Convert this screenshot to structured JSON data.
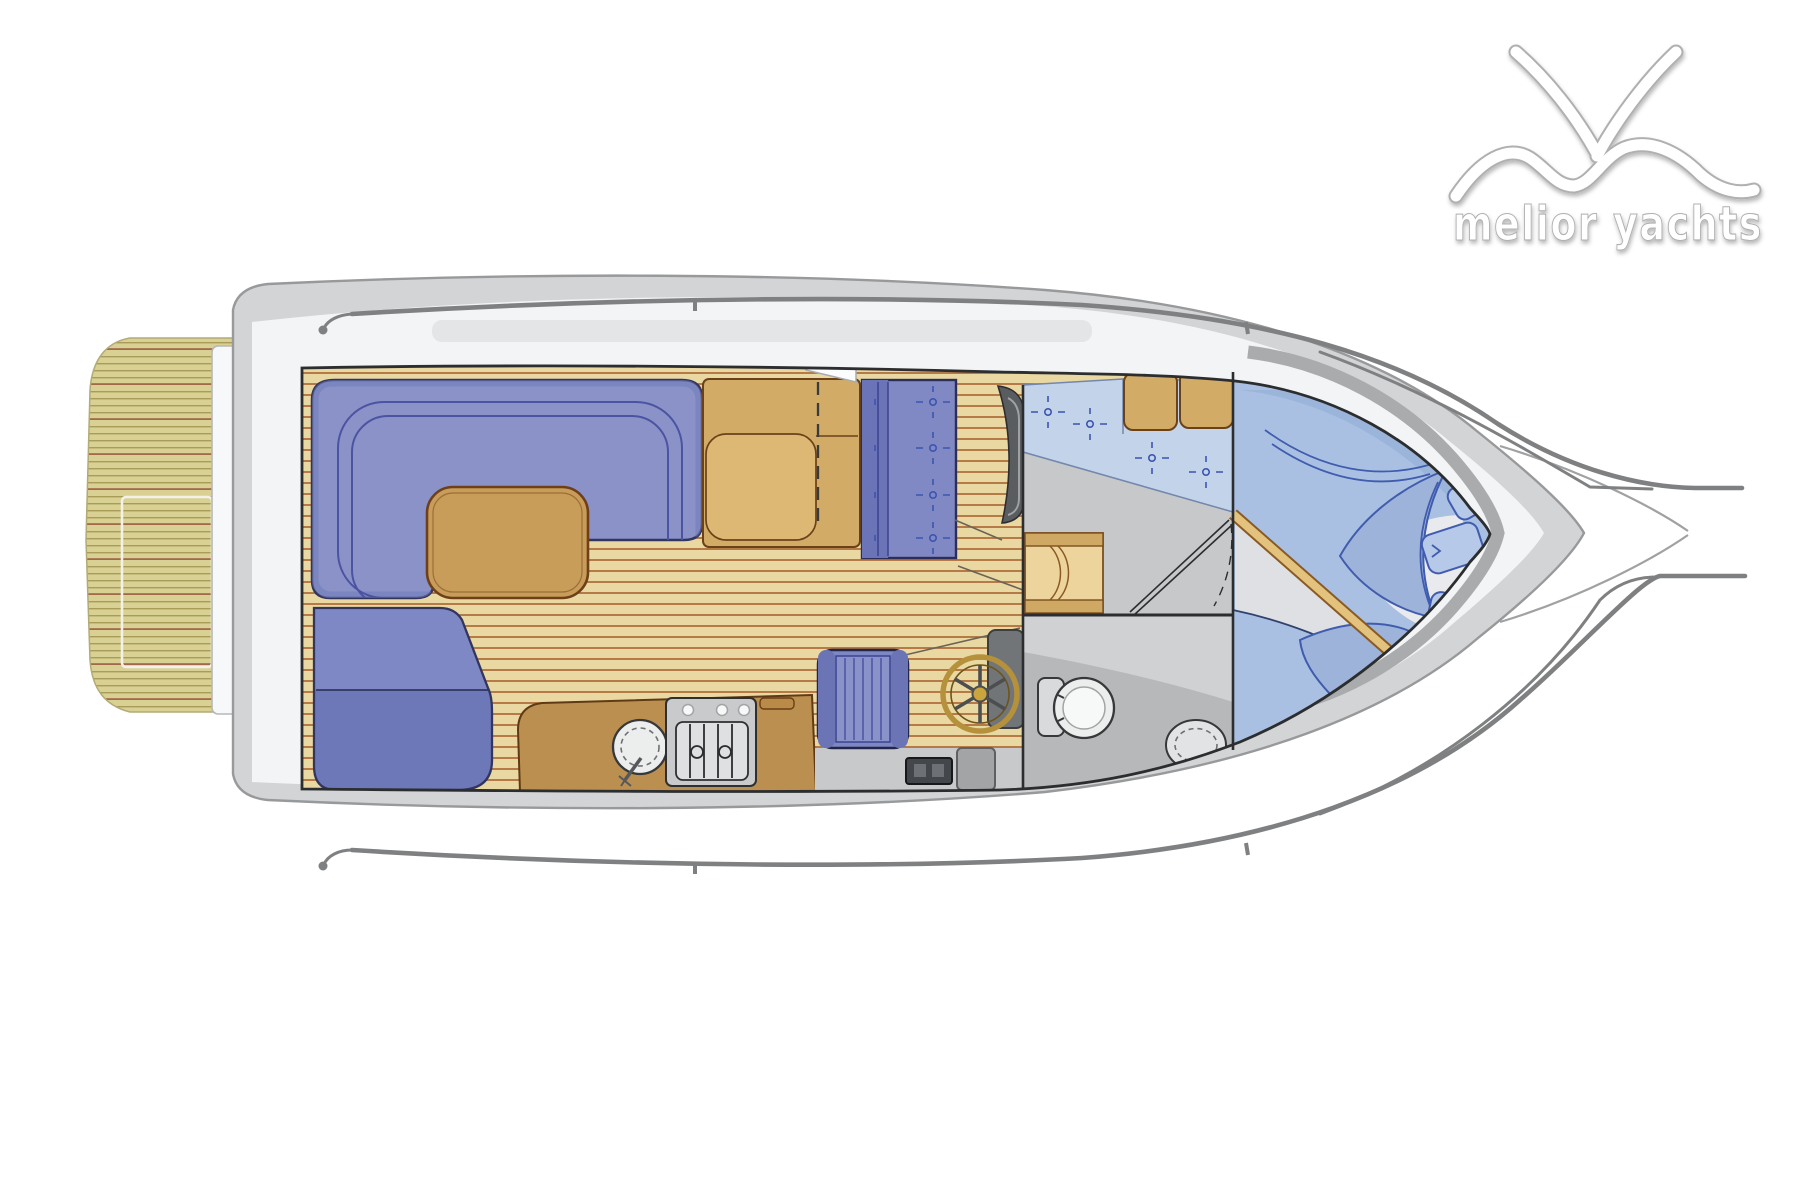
{
  "logo": {
    "text": "melior yachts"
  },
  "colors": {
    "hull_band": "#d2d4d6",
    "hull_line": "#97999b",
    "deck": "#f3f4f6",
    "gunwale": "#a9abac",
    "rail": "#7e8082",
    "platform_base": "#d9d194",
    "platform_stripe": "#a89c58",
    "platform_accent": "#a2684a",
    "teak_base": "#ead8a2",
    "teak_stripe": "#aa6330",
    "counter": "#ba8f4f",
    "furniture_tan": "#d2ab66",
    "table_tan": "#c79d59",
    "wood_trim": "#d9b267",
    "tan_outline": "#6b4118",
    "sofa_blue": "#8a92c8",
    "sofa_shade": "#707ab8",
    "sofa_outline": "#32355e",
    "sofa_line": "#4c53a2",
    "bench_seat": "#6d78b8",
    "cushion_blue": "#c3d4ea",
    "bed_blue": "#a9c0e2",
    "bed_shade": "#8fa9d4",
    "navy": "#3f5cae",
    "button_blue": "#3b55b0",
    "landing_floor": "#c6c8ca",
    "head_wall": "#cfd1d3",
    "head_floor": "#b6b8ba",
    "fwd_floor": "#dfe0e3",
    "fixture": "#eceded",
    "stove_gray": "#c9cacc",
    "dark_line": "#2c2d2f",
    "logo_fill": "#ffffff",
    "logo_outline": "#b0b0b2"
  },
  "plan_features": [
    "swim-platform",
    "platform-hatch",
    "transom-ladder",
    "hull",
    "bow-pulpit",
    "side-handrails",
    "cockpit-u-sofa",
    "cockpit-table",
    "aft-bench",
    "galley-counter",
    "galley-sink",
    "galley-stove",
    "companionway",
    "copilot-bench",
    "helm-console",
    "helm-seat",
    "steering-wheel",
    "cabin-steps",
    "mid-cabin-berths",
    "storage-cabinets",
    "head-toilet",
    "head-sink",
    "head-door",
    "v-berth-bed",
    "pillows",
    "deck-hatches"
  ]
}
